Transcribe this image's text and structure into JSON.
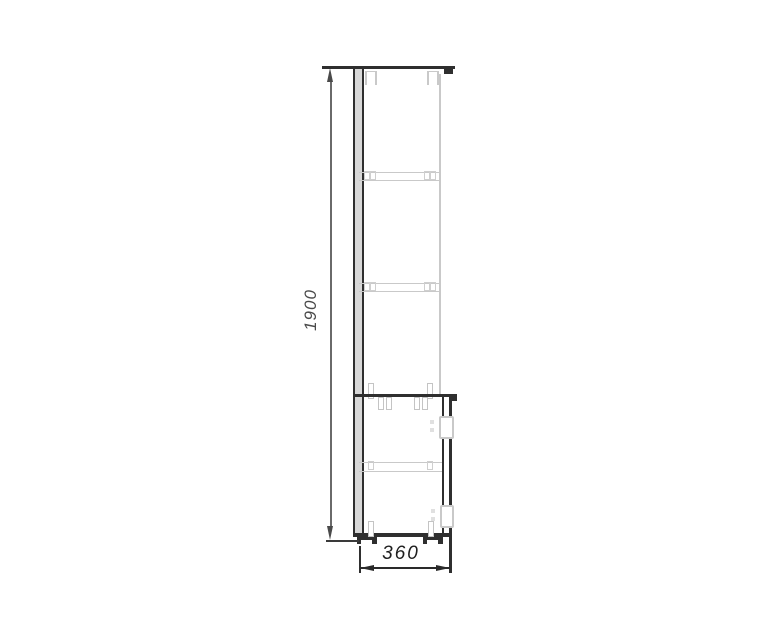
{
  "drawing": {
    "title": "cabinet-side-elevation",
    "height_dimension": {
      "label": "1900"
    },
    "width_dimension": {
      "label": "360"
    },
    "colors": {
      "outline": "#2f2f2f",
      "hidden_detail": "#c9c9c9",
      "dimension_line": "#6a6a6a",
      "dimension_text": "#4a4a4a",
      "background": "#ffffff"
    }
  }
}
